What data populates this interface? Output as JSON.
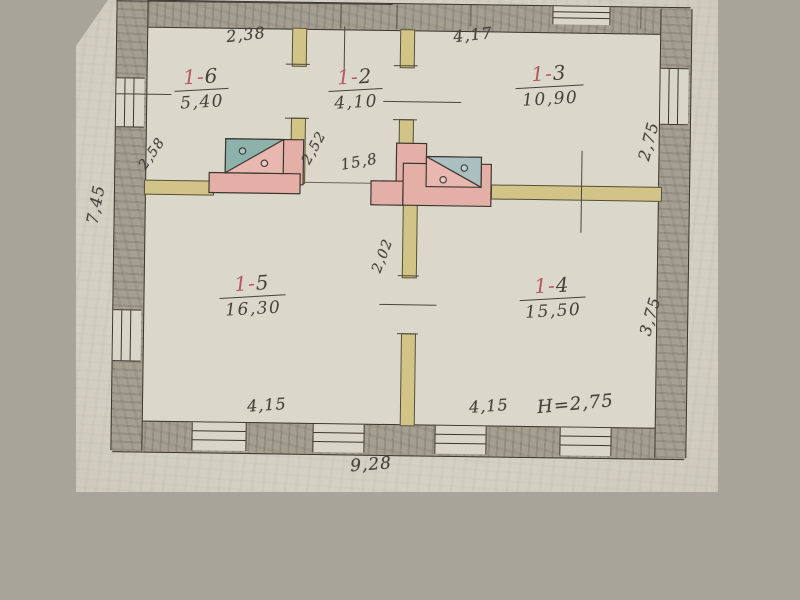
{
  "document": {
    "kind": "scanned hand-drawn floor plan",
    "floor_height_note": "Н=2,75"
  },
  "rooms": [
    {
      "id_prefix": "1-",
      "id_digit": "6",
      "area": "5,40"
    },
    {
      "id_prefix": "1-",
      "id_digit": "2",
      "area": "4,10"
    },
    {
      "id_prefix": "1-",
      "id_digit": "3",
      "area": "10,90"
    },
    {
      "id_prefix": "1-",
      "id_digit": "5",
      "area": "16,30"
    },
    {
      "id_prefix": "1-",
      "id_digit": "4",
      "area": "15,50"
    }
  ],
  "dimensions": {
    "top_left": "2,38",
    "top_right": "4,17",
    "right_upper": "2,75",
    "right_lower": "3,75",
    "left_outer": "7,45",
    "room16_side": "2,58",
    "room12_side": "2,52",
    "center_mid": "15,8",
    "center_door": "2,02",
    "bottom_left": "4,15",
    "bottom_right": "4,15",
    "height_note": "Н=2,75",
    "overall_width": "9,28"
  },
  "colors": {
    "paper": "#d7d3c6",
    "scan_margin": "#a9a49a",
    "wall_fill": "#a59f92",
    "wall_line": "#3b372f",
    "partition": "#d2c487",
    "stove_pink": "#e4afa7",
    "stove_teal": "#8db2ab",
    "ink": "#46413a",
    "red_ink": "#b25a60"
  }
}
